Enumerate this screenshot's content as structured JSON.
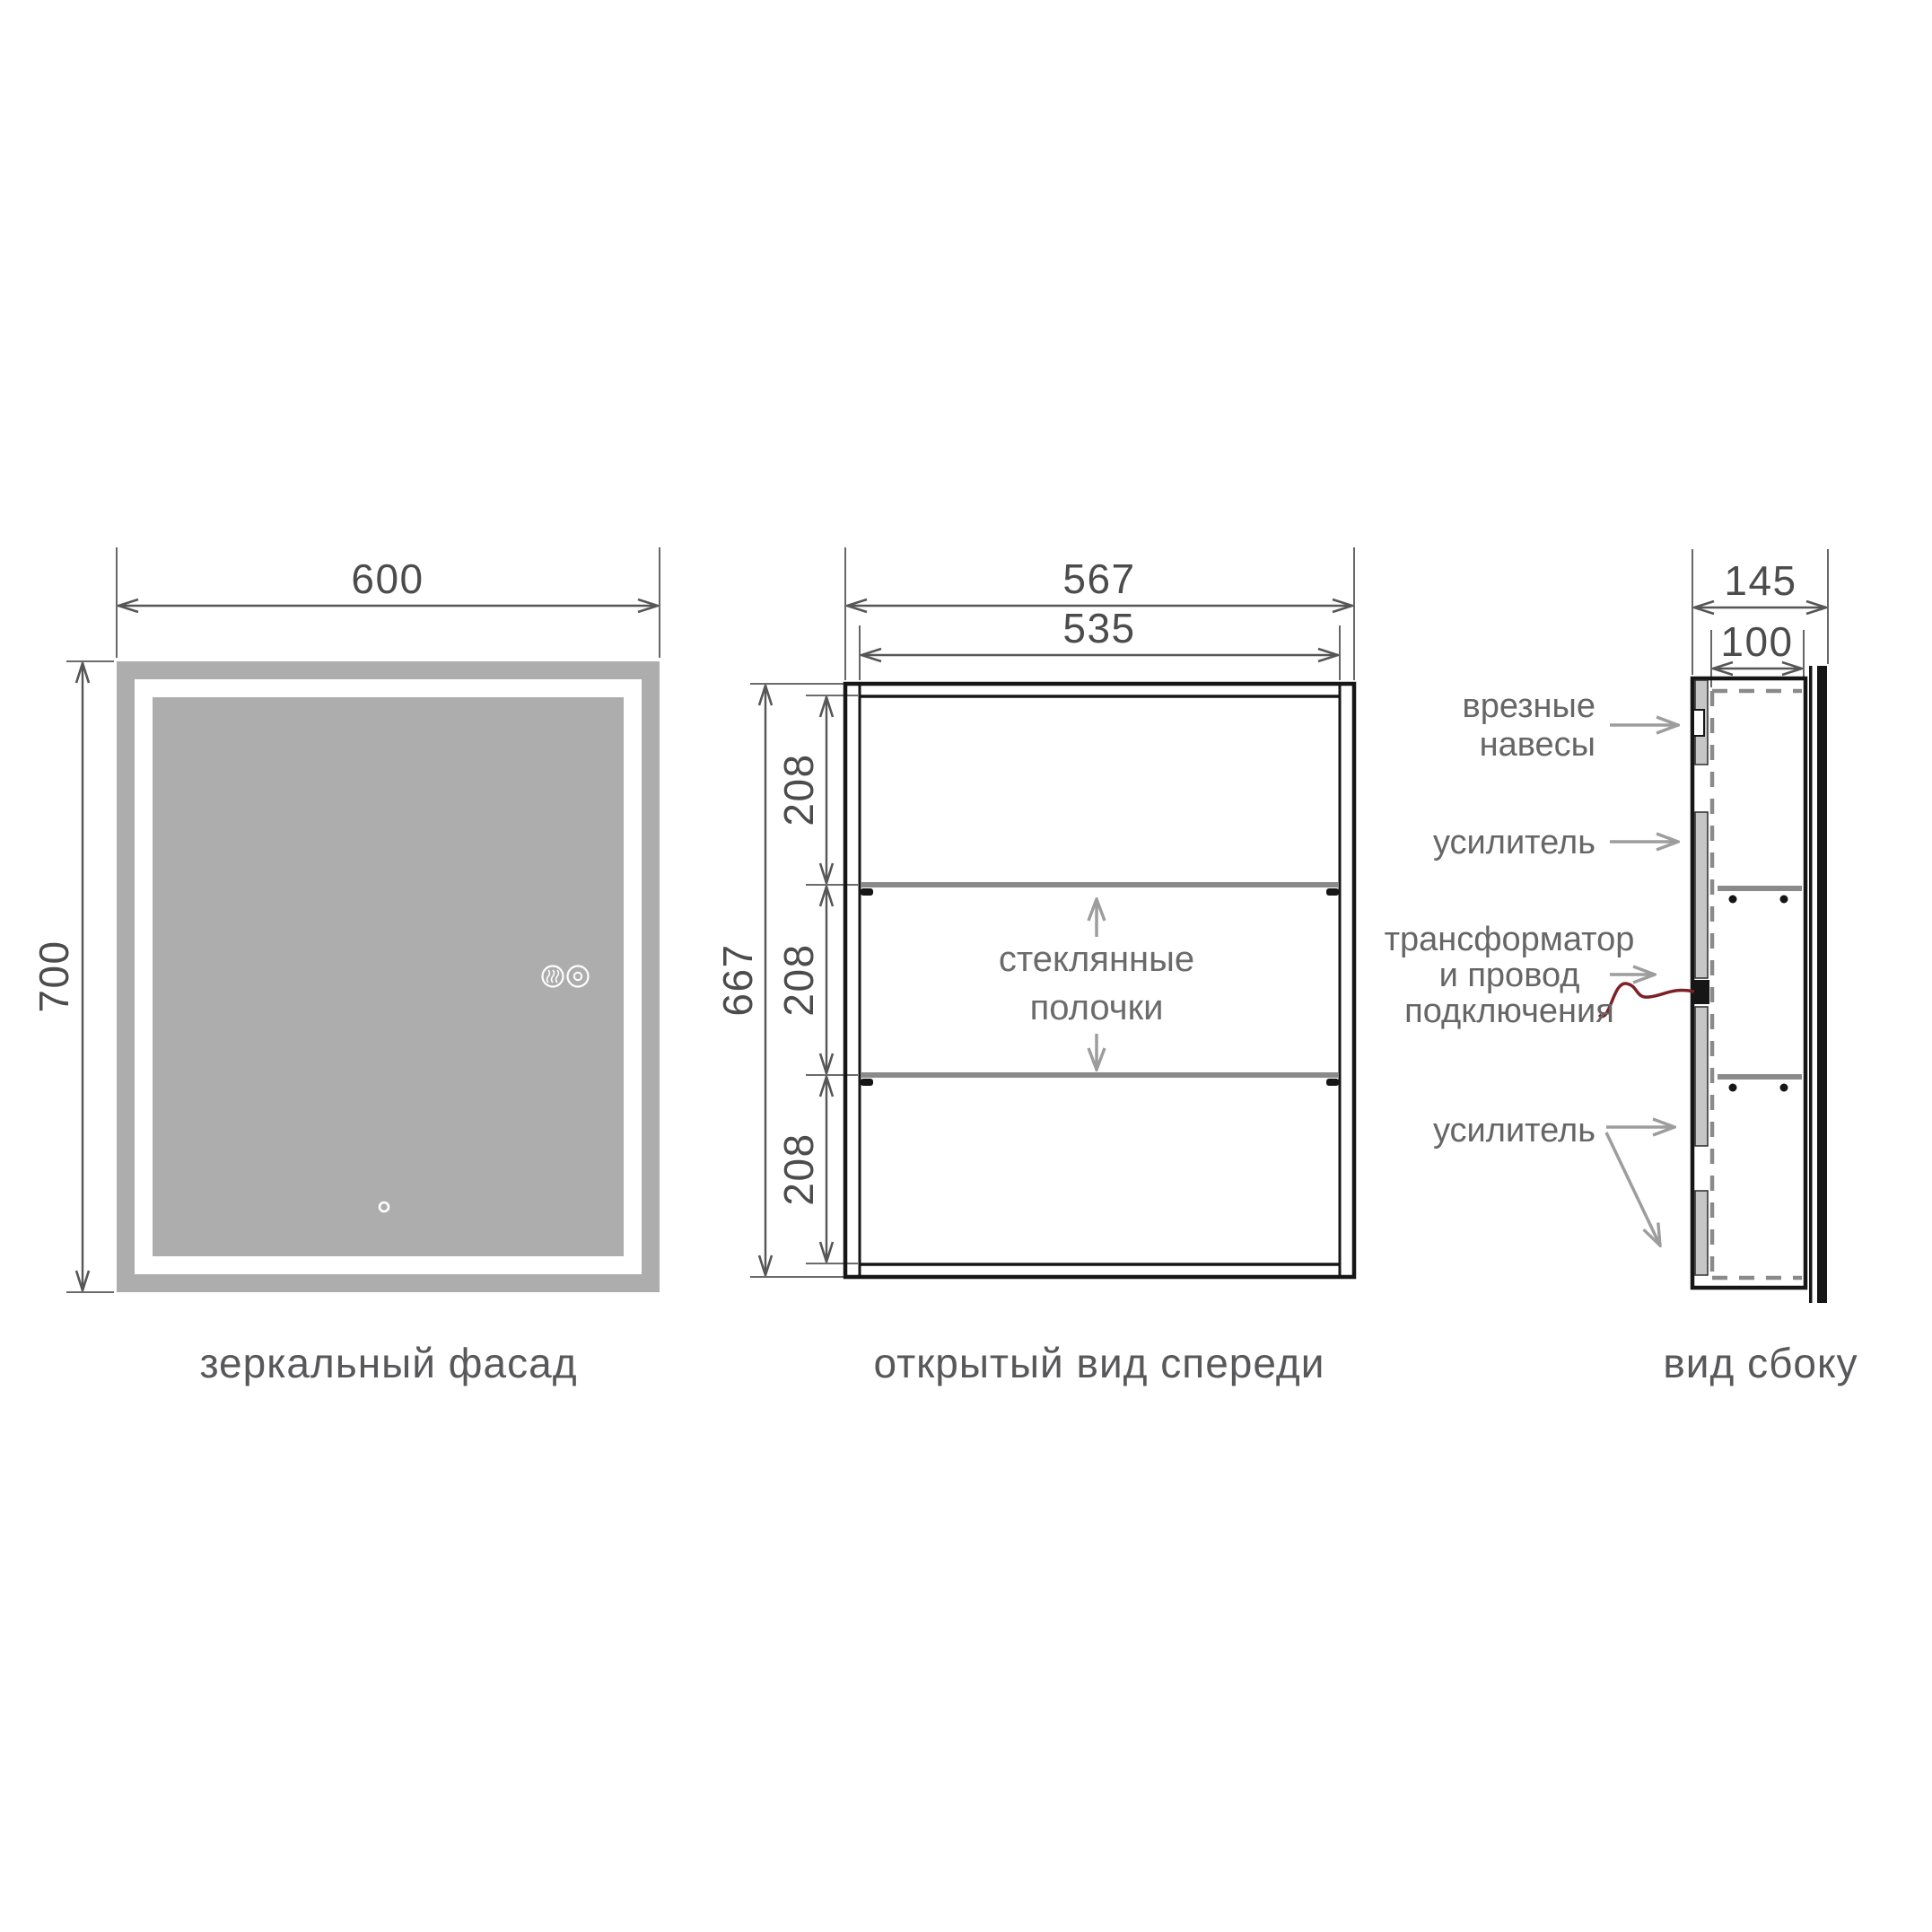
{
  "views": {
    "front_mirror": {
      "caption": "зеркальный фасад",
      "dims": {
        "width": "600",
        "height": "700"
      },
      "icons": {
        "left": "defog-icon",
        "right": "power-icon",
        "bottom": "sensor-icon"
      }
    },
    "front_open": {
      "caption": "открытый вид спереди",
      "dims": {
        "outer_width": "567",
        "inner_width": "535",
        "height": "667",
        "section": "208"
      },
      "shelf_label": [
        "стеклянные",
        "полочки"
      ]
    },
    "side": {
      "caption": "вид сбоку",
      "dims": {
        "depth_total": "145",
        "depth_body": "100"
      },
      "labels": {
        "hinges": [
          "врезные",
          "навесы"
        ],
        "stiffener_top": "усилитель",
        "transformer": [
          "трансформатор",
          "и провод",
          "подключения"
        ],
        "stiffener_bottom": "усилитель"
      }
    }
  },
  "colors": {
    "mirror_gray": "#adadad",
    "line_dark": "#161616",
    "dim_gray": "#565656",
    "text_dim": "#4c4c4c",
    "caption_gray": "#58585a",
    "label_gray": "#666666",
    "arrow_gray": "#9d9d9d",
    "shelf_gray": "#8a8a8a",
    "dash_gray": "#8a8a8a",
    "panel_gray": "#c6c6c6",
    "wire_red": "#7d2128"
  }
}
